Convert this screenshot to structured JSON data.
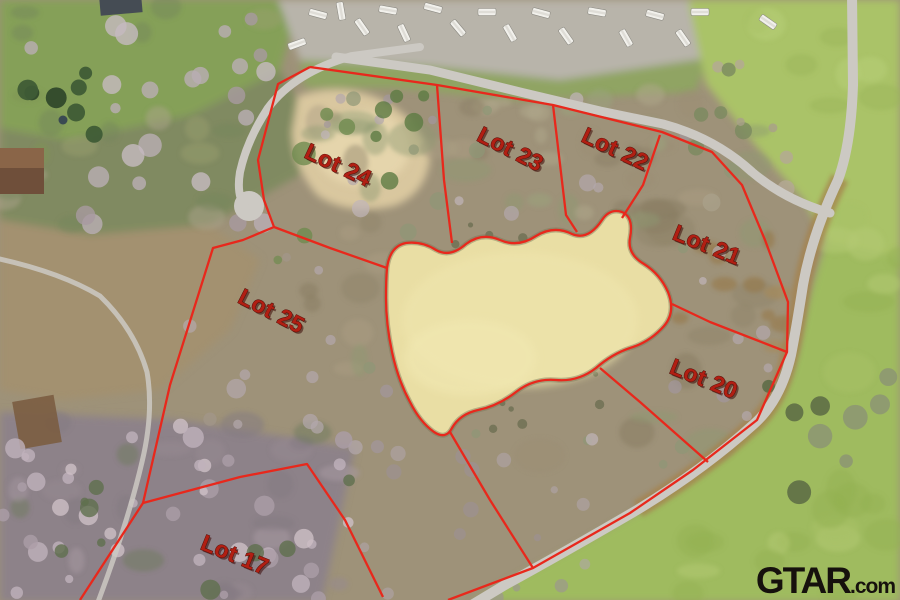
{
  "scene": {
    "description": "Aerial drone photo of wooded acreage subdivision with pond, red lot boundary overlay",
    "rv_park_vehicle_count": 18
  },
  "watermark": {
    "brand": "GTAR",
    "tld": ".com"
  },
  "colors": {
    "boundary": "#e8281c",
    "label_fill": "#b11f13",
    "label_edge": "#4d0c06",
    "pond": "#e9dea4",
    "road": "#ccc9c3"
  },
  "labels": [
    {
      "id": "lot-24",
      "text": "Lot 24",
      "x": 335,
      "y": 172,
      "rot": 25
    },
    {
      "id": "lot-23",
      "text": "Lot 23",
      "x": 507,
      "y": 156,
      "rot": 27
    },
    {
      "id": "lot-22",
      "text": "Lot 22",
      "x": 612,
      "y": 156,
      "rot": 25
    },
    {
      "id": "lot-21",
      "text": "Lot 21",
      "x": 704,
      "y": 252,
      "rot": 22
    },
    {
      "id": "lot-25",
      "text": "Lot 25",
      "x": 268,
      "y": 318,
      "rot": 27
    },
    {
      "id": "lot-20",
      "text": "Lot 20",
      "x": 701,
      "y": 386,
      "rot": 22
    },
    {
      "id": "lot-17",
      "text": "Lot 17",
      "x": 232,
      "y": 562,
      "rot": 22
    }
  ],
  "geometry": {
    "pond_path": "M387,268 Q390,246 406,243 Q422,241 436,250 Q450,258 466,244 Q482,232 500,240 Q518,248 536,236 Q554,225 572,234 Q588,241 602,220 Q610,208 622,212 Q634,217 630,238 Q627,254 644,264 Q660,274 668,292 Q676,312 664,326 Q650,342 630,348 Q612,354 596,368 Q578,382 556,380 Q534,378 516,392 Q498,406 478,410 Q460,414 452,428 Q446,440 434,432 Q420,422 410,402 Q398,380 392,352 Q386,324 386,298 Q386,280 387,268 Z",
    "boundary_lines": [
      {
        "id": "outer-top-east",
        "points": "310,67 437,85 553,105 662,132 712,152 742,185 765,240 788,302 787,352 757,420 693,470 630,513 533,568 448,600"
      },
      {
        "id": "outer-west",
        "points": "310,67 278,84 258,160 264,200 274,227 243,240 213,248 170,385 143,503 80,600"
      },
      {
        "id": "divider-lot24-lot25",
        "points": "274,227 330,248 387,268"
      },
      {
        "id": "divider-lot24-lot23",
        "points": "437,85 444,180 452,243"
      },
      {
        "id": "divider-lot23-lot22",
        "points": "553,105 566,215 577,232"
      },
      {
        "id": "divider-lot22-lot21",
        "points": "660,135 643,185 622,218"
      },
      {
        "id": "divider-lot21-lot20",
        "points": "672,304 710,322 787,352"
      },
      {
        "id": "divider-lot20-south",
        "points": "600,368 640,402 708,462"
      },
      {
        "id": "divider-south-lots",
        "points": "450,432 490,500 533,568"
      },
      {
        "id": "divider-lot25-lot17",
        "points": "143,503 240,477 307,464 345,520 383,597"
      }
    ],
    "roads": [
      {
        "id": "main-road-top",
        "d": "M336,57 L430,70 L520,92 L600,111 L663,124 Q715,138 752,172 Q785,200 830,213",
        "w": 9
      },
      {
        "id": "right-road",
        "d": "M852,-6 L853,85 Q851,145 838,180 Q812,235 803,285 Q796,330 791,355 Q781,400 754,424 Q703,470 637,510 Q565,552 505,585 L470,606",
        "w": 10
      },
      {
        "id": "culdesac-road",
        "d": "M420,47 L352,56 Q295,72 268,108 Q247,140 240,172 Q236,196 246,208",
        "w": 8,
        "bulb": [
          249,
          206,
          15
        ]
      },
      {
        "id": "left-trail",
        "d": "M-5,258 Q60,272 100,296 Q135,330 147,372 Q154,412 142,462 Q128,522 98,602",
        "w": 5
      }
    ],
    "rv_positions": [
      [
        297,
        44,
        -20
      ],
      [
        318,
        14,
        15
      ],
      [
        341,
        11,
        80
      ],
      [
        362,
        27,
        55
      ],
      [
        388,
        10,
        10
      ],
      [
        404,
        33,
        65
      ],
      [
        433,
        8,
        15
      ],
      [
        458,
        28,
        50
      ],
      [
        487,
        12,
        0
      ],
      [
        510,
        33,
        60
      ],
      [
        541,
        13,
        15
      ],
      [
        566,
        36,
        55
      ],
      [
        597,
        12,
        10
      ],
      [
        626,
        38,
        60
      ],
      [
        655,
        15,
        15
      ],
      [
        683,
        38,
        55
      ],
      [
        700,
        12,
        0
      ],
      [
        768,
        22,
        35
      ]
    ]
  }
}
